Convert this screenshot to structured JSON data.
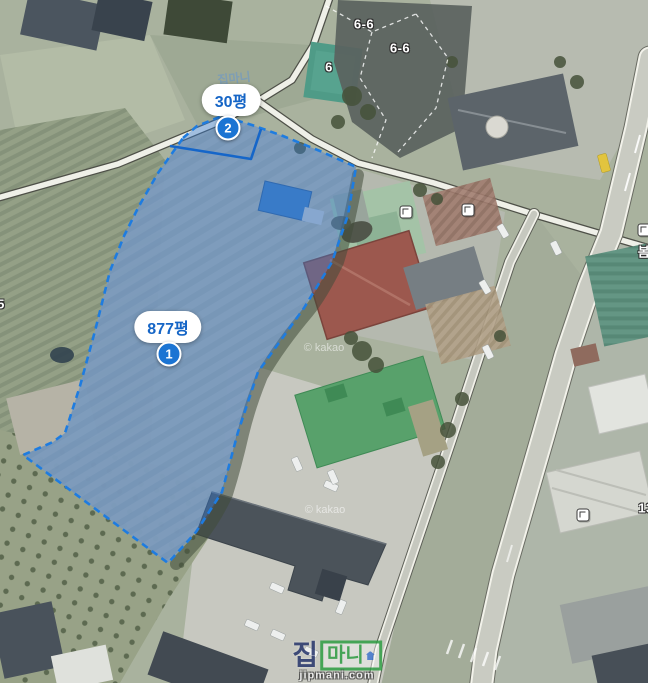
{
  "map": {
    "provider_attributions": [
      {
        "text": "© kakao"
      },
      {
        "text": "© kakao"
      }
    ],
    "highlight": {
      "fill_rgba": "rgba(52,122,210,0.42)",
      "stroke_color": "#1e7ce0",
      "inner_line_color": "#1566c9",
      "badge_color": "#1b74d3",
      "label_text_color": "#1565c6",
      "parcel1": {
        "label": "877평",
        "badge": "1"
      },
      "parcel2": {
        "label": "30평",
        "badge": "2"
      }
    },
    "parcel_numbers": [
      {
        "text": "6-6"
      },
      {
        "text": "6-6"
      },
      {
        "text": "6"
      },
      {
        "text": "5"
      },
      {
        "text": "봄"
      },
      {
        "text": "13"
      }
    ],
    "watermark": {
      "jip": "집",
      "mani": "마니",
      "domain": "jipmani.com",
      "small_mark": "집마니"
    }
  }
}
